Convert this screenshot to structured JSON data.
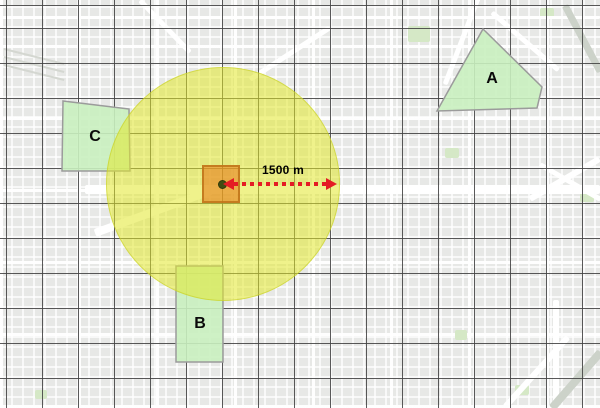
{
  "annotation": {
    "distance_label": "1500 m",
    "distance_value_m": 1500
  },
  "zones": [
    {
      "id": "A",
      "label": "A"
    },
    {
      "id": "B",
      "label": "B"
    },
    {
      "id": "C",
      "label": "C"
    }
  ],
  "colors": {
    "buffer_fill": "#e4e782",
    "zone_fill": "#c9efbf",
    "zone_stroke": "#9b9b9b",
    "center_square_fill": "#e8a24d",
    "center_square_stroke": "#cd8a33",
    "center_point": "#404d12",
    "arrow_red": "#e41c24",
    "graticule": "#444444",
    "basemap_bg": "#e7e8e6",
    "street": "#ffffff",
    "park": "#d5e8c6"
  }
}
